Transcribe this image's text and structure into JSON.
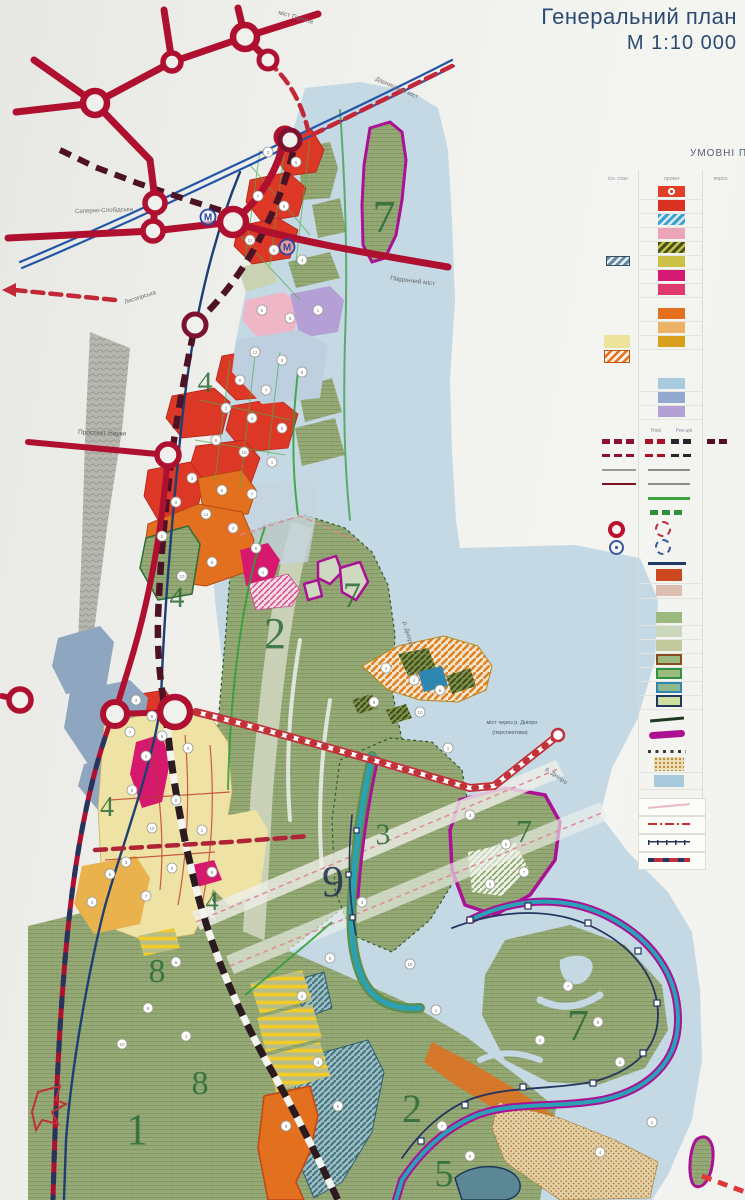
{
  "title": {
    "line1": "Генеральний план",
    "line2": "М 1:10 000"
  },
  "legend": {
    "header": "УМОВНІ ПО",
    "columns": [
      {
        "label": "існ. стан",
        "x": 618
      },
      {
        "label": "проект",
        "x": 672
      },
      {
        "label": "персп.",
        "x": 721
      }
    ],
    "sub_columns": [
      {
        "label": "Нові",
        "x": 656
      },
      {
        "label": "Рек-ція",
        "x": 684
      }
    ],
    "sub_header_y": 428,
    "grid_x": [
      638,
      702
    ],
    "rows": [
      {
        "y": 191,
        "g": 1,
        "m": [
          {
            "x": 658,
            "w": 27,
            "h": 11,
            "t": "circledot",
            "c": "#e04027"
          }
        ]
      },
      {
        "y": 205,
        "g": 1,
        "m": [
          {
            "x": 658,
            "w": 27,
            "h": 11,
            "t": "solid",
            "c": "#da3222"
          }
        ]
      },
      {
        "y": 219,
        "g": 1,
        "m": [
          {
            "x": 658,
            "w": 27,
            "h": 11,
            "t": "hatch",
            "c": "#3e9ecf",
            "c2": "#d8ecf6"
          }
        ]
      },
      {
        "y": 233,
        "g": 1,
        "m": [
          {
            "x": 658,
            "w": 27,
            "h": 11,
            "t": "solid",
            "c": "#eda4b6"
          }
        ]
      },
      {
        "y": 247,
        "g": 1,
        "m": [
          {
            "x": 658,
            "w": 27,
            "h": 11,
            "t": "hatch",
            "c": "#44511f",
            "c2": "#c8c23e"
          }
        ]
      },
      {
        "y": 261,
        "g": 1,
        "m": [
          {
            "x": 606,
            "w": 24,
            "h": 10,
            "t": "hatch",
            "c": "#678ba2",
            "c2": "#e8eef2",
            "b": "#33505f"
          },
          {
            "x": 658,
            "w": 27,
            "h": 11,
            "t": "solid",
            "c": "#cdc248"
          }
        ]
      },
      {
        "y": 275,
        "g": 1,
        "m": [
          {
            "x": 658,
            "w": 27,
            "h": 11,
            "t": "solid",
            "c": "#d41a72"
          }
        ]
      },
      {
        "y": 289,
        "g": 1,
        "m": [
          {
            "x": 658,
            "w": 27,
            "h": 11,
            "t": "solid",
            "c": "#df3a70"
          }
        ]
      },
      {
        "y": 313,
        "g": 1,
        "m": [
          {
            "x": 658,
            "w": 27,
            "h": 11,
            "t": "solid",
            "c": "#e2701f"
          }
        ]
      },
      {
        "y": 327,
        "g": 1,
        "m": [
          {
            "x": 658,
            "w": 27,
            "h": 11,
            "t": "solid",
            "c": "#ecb266"
          }
        ]
      },
      {
        "y": 341,
        "g": 1,
        "m": [
          {
            "x": 604,
            "w": 26,
            "h": 13,
            "t": "solid",
            "c": "#ece49c"
          },
          {
            "x": 658,
            "w": 27,
            "h": 11,
            "t": "solid",
            "c": "#d9a01e"
          }
        ]
      },
      {
        "y": 356,
        "m": [
          {
            "x": 604,
            "w": 26,
            "h": 13,
            "t": "hatch",
            "c": "#f6f1e2",
            "c2": "#e2701f",
            "b": "#c05515"
          }
        ]
      },
      {
        "y": 383,
        "g": 1,
        "m": [
          {
            "x": 658,
            "w": 27,
            "h": 11,
            "t": "solid",
            "c": "#a9cbe0"
          }
        ]
      },
      {
        "y": 397,
        "g": 1,
        "m": [
          {
            "x": 658,
            "w": 27,
            "h": 11,
            "t": "solid",
            "c": "#92a8cc"
          }
        ]
      },
      {
        "y": 411,
        "g": 1,
        "m": [
          {
            "x": 658,
            "w": 27,
            "h": 11,
            "t": "solid",
            "c": "#b3a0d4"
          }
        ]
      },
      {
        "y": 441,
        "m": [
          {
            "x": 602,
            "w": 34,
            "h": 5,
            "t": "dash",
            "c": "#8e1030"
          },
          {
            "x": 645,
            "w": 22,
            "h": 5,
            "t": "dash",
            "c": "#aa1228"
          },
          {
            "x": 671,
            "w": 22,
            "h": 5,
            "t": "dash",
            "c": "#26262a"
          },
          {
            "x": 707,
            "w": 24,
            "h": 5,
            "t": "dash",
            "c": "#551020"
          }
        ]
      },
      {
        "y": 455,
        "m": [
          {
            "x": 602,
            "w": 34,
            "h": 3,
            "t": "dash",
            "c": "#8e1030"
          },
          {
            "x": 645,
            "w": 22,
            "h": 3,
            "t": "dash",
            "c": "#aa1228"
          },
          {
            "x": 671,
            "w": 22,
            "h": 3,
            "t": "dash",
            "c": "#26262a"
          }
        ]
      },
      {
        "y": 470,
        "m": [
          {
            "x": 602,
            "w": 34,
            "h": 2,
            "t": "solid",
            "c": "#9a9a9a"
          },
          {
            "x": 648,
            "w": 42,
            "h": 2,
            "t": "solid",
            "c": "#8a8a8a"
          }
        ]
      },
      {
        "y": 484,
        "m": [
          {
            "x": 602,
            "w": 34,
            "h": 2,
            "t": "solid",
            "c": "#7c1220"
          },
          {
            "x": 648,
            "w": 42,
            "h": 2,
            "t": "solid",
            "c": "#8a8a8a"
          }
        ]
      },
      {
        "y": 498,
        "m": [
          {
            "x": 648,
            "w": 42,
            "h": 3,
            "t": "solid",
            "c": "#3aa23e"
          }
        ]
      },
      {
        "y": 512,
        "m": [
          {
            "x": 650,
            "w": 36,
            "h": 5,
            "t": "dash",
            "c": "#2e8f3a"
          }
        ]
      },
      {
        "y": 529,
        "m": [
          {
            "x": 608,
            "t": "ring",
            "c": "#bb1030",
            "s": 17
          },
          {
            "x": 655,
            "t": "dashring",
            "c": "#c22838",
            "s": 16
          }
        ]
      },
      {
        "y": 547,
        "m": [
          {
            "x": 609,
            "t": "mcircle",
            "c": "#3a57a0",
            "s": 15
          },
          {
            "x": 655,
            "t": "dashring",
            "c": "#3a57a0",
            "s": 16
          }
        ]
      },
      {
        "y": 563,
        "m": [
          {
            "x": 648,
            "w": 38,
            "h": 3,
            "t": "solid",
            "c": "#1d3a66"
          }
        ]
      },
      {
        "y": 575,
        "g": 1,
        "m": [
          {
            "x": 656,
            "w": 26,
            "h": 12,
            "t": "solid",
            "c": "#cc4a1d"
          }
        ]
      },
      {
        "y": 590,
        "g": 1,
        "m": [
          {
            "x": 656,
            "w": 26,
            "h": 11,
            "t": "solid",
            "c": "#ddbfb2"
          }
        ]
      },
      {
        "y": 617,
        "g": 1,
        "m": [
          {
            "x": 656,
            "w": 26,
            "h": 11,
            "t": "solid",
            "c": "#9cba80"
          }
        ]
      },
      {
        "y": 631,
        "g": 1,
        "m": [
          {
            "x": 656,
            "w": 26,
            "h": 11,
            "t": "solid",
            "c": "#ccd8bc"
          }
        ]
      },
      {
        "y": 645,
        "g": 1,
        "m": [
          {
            "x": 656,
            "w": 26,
            "h": 11,
            "t": "solid",
            "c": "#c2c99c"
          }
        ]
      },
      {
        "y": 659,
        "g": 1,
        "m": [
          {
            "x": 656,
            "w": 26,
            "h": 11,
            "t": "border",
            "c": "#9cba80",
            "b": "#8a4a20"
          }
        ]
      },
      {
        "y": 673,
        "g": 1,
        "m": [
          {
            "x": 656,
            "w": 26,
            "h": 11,
            "t": "border",
            "c": "#9cba80",
            "b": "#2f9440"
          }
        ]
      },
      {
        "y": 687,
        "g": 1,
        "m": [
          {
            "x": 656,
            "w": 26,
            "h": 11,
            "t": "border",
            "c": "#8fb98c",
            "b": "#2f86b0"
          }
        ]
      },
      {
        "y": 701,
        "g": 1,
        "m": [
          {
            "x": 656,
            "w": 26,
            "h": 12,
            "t": "border",
            "c": "#cfdf9f",
            "b": "#20365c"
          }
        ]
      },
      {
        "y": 719,
        "m": [
          {
            "x": 650,
            "w": 34,
            "h": 3,
            "t": "slant",
            "c": "#1f3a20"
          }
        ]
      },
      {
        "y": 734,
        "m": [
          {
            "x": 649,
            "w": 36,
            "h": 7,
            "t": "round",
            "c": "#ab1090"
          }
        ]
      },
      {
        "y": 751,
        "m": [
          {
            "x": 648,
            "w": 38,
            "h": 3,
            "t": "dots",
            "c": "#3a3a3a"
          }
        ]
      },
      {
        "y": 764,
        "g": 1,
        "m": [
          {
            "x": 654,
            "w": 30,
            "h": 14,
            "t": "speckle",
            "c": "#ecddb6",
            "c2": "#b5863a"
          }
        ]
      },
      {
        "y": 781,
        "g": 1,
        "m": [
          {
            "x": 654,
            "w": 30,
            "h": 12,
            "t": "solid",
            "c": "#a8c8dc"
          }
        ]
      },
      {
        "y": 806,
        "box": 1,
        "m": [
          {
            "x": 648,
            "w": 42,
            "h": 2,
            "t": "slant",
            "c": "#e8b8c8"
          }
        ]
      },
      {
        "y": 824,
        "box": 1,
        "m": [
          {
            "x": 648,
            "w": 42,
            "h": 2,
            "t": "dashdot",
            "c": "#c03038"
          }
        ]
      },
      {
        "y": 842,
        "box": 1,
        "m": [
          {
            "x": 648,
            "w": 42,
            "h": 5,
            "t": "ticks",
            "c": "#25355e"
          }
        ]
      },
      {
        "y": 860,
        "box": 1,
        "m": [
          {
            "x": 648,
            "w": 42,
            "h": 4,
            "t": "dashover",
            "c": "#c03038",
            "c2": "#25355e"
          }
        ]
      }
    ]
  },
  "map": {
    "zone_labels": [
      {
        "t": "7",
        "x": 384,
        "y": 232,
        "s": 46,
        "c": "#2d6b38"
      },
      {
        "t": "4",
        "x": 205,
        "y": 392,
        "s": 30,
        "c": "#2d6b38"
      },
      {
        "t": "4",
        "x": 177,
        "y": 607,
        "s": 30,
        "c": "#2d6b38"
      },
      {
        "t": "2",
        "x": 275,
        "y": 648,
        "s": 44,
        "c": "#2d6b38"
      },
      {
        "t": "7",
        "x": 352,
        "y": 607,
        "s": 36,
        "c": "#2d6b38"
      },
      {
        "t": "4",
        "x": 107,
        "y": 816,
        "s": 28,
        "c": "#2d6b38"
      },
      {
        "t": "3",
        "x": 383,
        "y": 844,
        "s": 30,
        "c": "#2d6b38"
      },
      {
        "t": "9",
        "x": 333,
        "y": 896,
        "s": 44,
        "c": "#1d2f4e"
      },
      {
        "t": "4",
        "x": 212,
        "y": 910,
        "s": 26,
        "c": "#2d6b38"
      },
      {
        "t": "7",
        "x": 524,
        "y": 842,
        "s": 32,
        "c": "#2d6b38"
      },
      {
        "t": "8",
        "x": 157,
        "y": 982,
        "s": 34,
        "c": "#2d6b38"
      },
      {
        "t": "8",
        "x": 200,
        "y": 1094,
        "s": 34,
        "c": "#2d6b38"
      },
      {
        "t": "1",
        "x": 137,
        "y": 1144,
        "s": 44,
        "c": "#2d6b38"
      },
      {
        "t": "2",
        "x": 412,
        "y": 1122,
        "s": 40,
        "c": "#2d6b38"
      },
      {
        "t": "7",
        "x": 578,
        "y": 1040,
        "s": 44,
        "c": "#2d6b38"
      },
      {
        "t": "5",
        "x": 444,
        "y": 1186,
        "s": 38,
        "c": "#2d6b38"
      }
    ],
    "road_labels": [
      {
        "t": "міст Патона",
        "x": 278,
        "y": 14,
        "r": 16,
        "s": 6.5,
        "c": "#707070"
      },
      {
        "t": "Дарницький міст",
        "x": 375,
        "y": 80,
        "r": 24,
        "s": 6,
        "c": "#707070"
      },
      {
        "t": "Південний міст",
        "x": 390,
        "y": 280,
        "r": 7,
        "s": 6.5,
        "c": "#6a6a6a"
      },
      {
        "t": "Саперно-Слобідська",
        "x": 75,
        "y": 213,
        "r": -2,
        "s": 6,
        "c": "#6a6a6a"
      },
      {
        "t": "Лисогірська",
        "x": 125,
        "y": 304,
        "r": -18,
        "s": 6,
        "c": "#6a6a6a"
      },
      {
        "t": "Проспект Науки",
        "x": 78,
        "y": 434,
        "r": 2,
        "s": 6.5,
        "c": "#555555"
      },
      {
        "t": "р. Дніпро",
        "x": 403,
        "y": 622,
        "r": 75,
        "s": 6,
        "c": "#5c6b74"
      },
      {
        "t": "р. Дніпро",
        "x": 545,
        "y": 770,
        "r": 35,
        "s": 6,
        "c": "#5c6b74"
      }
    ],
    "bridge_label": {
      "line1": "міст через р. Дніпро",
      "line2": "(перспектива)",
      "x": 512,
      "y": 724
    },
    "metro_letter": "М",
    "metro_stations": [
      {
        "x": 208,
        "y": 217
      },
      {
        "x": 287,
        "y": 247
      }
    ],
    "marker_circles": [
      [
        268,
        152,
        3
      ],
      [
        296,
        162,
        5
      ],
      [
        258,
        196,
        7
      ],
      [
        284,
        206,
        9
      ],
      [
        250,
        240,
        11
      ],
      [
        274,
        250,
        2
      ],
      [
        302,
        260,
        4
      ],
      [
        262,
        310,
        6
      ],
      [
        290,
        318,
        8
      ],
      [
        318,
        310,
        1
      ],
      [
        255,
        352,
        12
      ],
      [
        282,
        360,
        3
      ],
      [
        240,
        380,
        5
      ],
      [
        266,
        390,
        7
      ],
      [
        302,
        372,
        9
      ],
      [
        226,
        408,
        2
      ],
      [
        252,
        418,
        4
      ],
      [
        282,
        428,
        6
      ],
      [
        216,
        440,
        8
      ],
      [
        244,
        452,
        10
      ],
      [
        272,
        462,
        1
      ],
      [
        192,
        478,
        3
      ],
      [
        222,
        490,
        5
      ],
      [
        252,
        494,
        7
      ],
      [
        176,
        502,
        9
      ],
      [
        206,
        514,
        11
      ],
      [
        162,
        536,
        2
      ],
      [
        233,
        528,
        4
      ],
      [
        256,
        548,
        6
      ],
      [
        212,
        562,
        8
      ],
      [
        182,
        576,
        10
      ],
      [
        263,
        572,
        1
      ],
      [
        136,
        700,
        3
      ],
      [
        152,
        716,
        5
      ],
      [
        130,
        732,
        7
      ],
      [
        162,
        736,
        9
      ],
      [
        146,
        756,
        2
      ],
      [
        188,
        748,
        4
      ],
      [
        132,
        790,
        6
      ],
      [
        176,
        800,
        8
      ],
      [
        152,
        828,
        10
      ],
      [
        202,
        830,
        1
      ],
      [
        126,
        862,
        3
      ],
      [
        172,
        868,
        5
      ],
      [
        146,
        896,
        7
      ],
      [
        212,
        872,
        9
      ],
      [
        386,
        668,
        2
      ],
      [
        414,
        680,
        4
      ],
      [
        440,
        690,
        6
      ],
      [
        374,
        702,
        8
      ],
      [
        420,
        712,
        10
      ],
      [
        448,
        748,
        1
      ],
      [
        470,
        815,
        3
      ],
      [
        506,
        844,
        5
      ],
      [
        524,
        872,
        7
      ],
      [
        490,
        884,
        9
      ],
      [
        302,
        996,
        2
      ],
      [
        318,
        1062,
        4
      ],
      [
        338,
        1106,
        6
      ],
      [
        286,
        1126,
        8
      ],
      [
        410,
        964,
        10
      ],
      [
        436,
        1010,
        1
      ],
      [
        362,
        902,
        3
      ],
      [
        330,
        958,
        5
      ],
      [
        568,
        986,
        7
      ],
      [
        598,
        1022,
        9
      ],
      [
        620,
        1062,
        2
      ],
      [
        540,
        1040,
        4
      ],
      [
        176,
        962,
        6
      ],
      [
        148,
        1008,
        8
      ],
      [
        122,
        1044,
        10
      ],
      [
        186,
        1036,
        1
      ],
      [
        92,
        902,
        3
      ],
      [
        110,
        874,
        5
      ],
      [
        442,
        1126,
        7
      ],
      [
        470,
        1156,
        9
      ],
      [
        652,
        1122,
        2
      ],
      [
        600,
        1152,
        4
      ]
    ]
  },
  "colors": {
    "title": "#2b4a72",
    "road_main": "#b01030",
    "road_planned": "#c22838",
    "metro_dash": "#4d1225",
    "river": "#c5d9e5",
    "land_green": "#95aa78",
    "zone_red": "#dd3726",
    "zone_orange": "#e2701f",
    "zone_magenta": "#d6186e",
    "zone_yellow": "#eee3a4",
    "zone_slate": "#8fa6c0",
    "border_magenta": "#aa1194",
    "channel_teal": "#29a2b6",
    "navy_line": "#1d3f73",
    "rail_dark": "#2b1a1e"
  }
}
